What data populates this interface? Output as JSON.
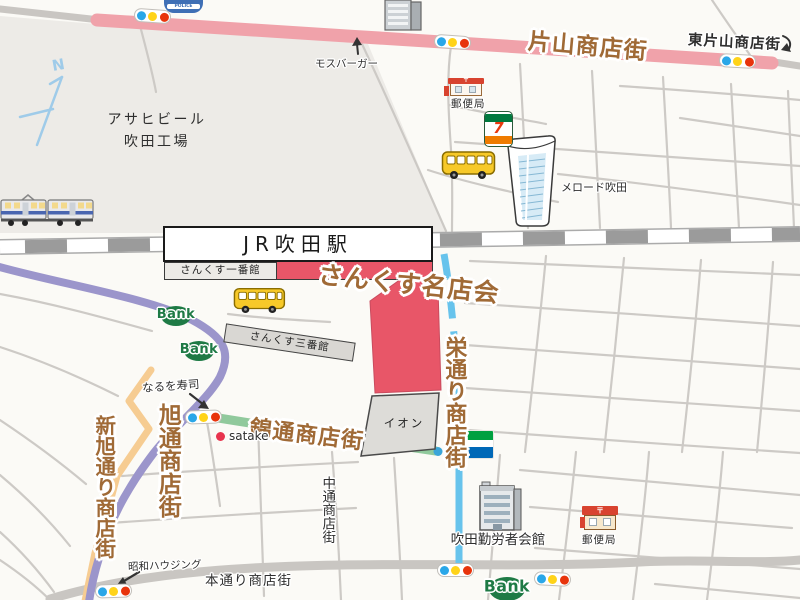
{
  "colors": {
    "bg": "#fbfaf6",
    "factory_tint": "#edebe7",
    "road_gray": "#c9c6c2",
    "road_thin": "#cbc8c4",
    "road_pink": "#f0a2aa",
    "road_purple": "#9b95cb",
    "road_blue": "#67c3ec",
    "road_green": "#90c99c",
    "road_orange": "#f6cc92",
    "rail_dark": "#9b9b9b",
    "block_red": "#e85668",
    "block_gray": "#dddcd8",
    "text_brown": "#a06a36",
    "text_dark": "#2e2e2e",
    "bank_green": "#1e7a45",
    "signal_blue": "#2aa7e8",
    "signal_yellow": "#ffd319",
    "signal_red": "#e8340c",
    "bus_yellow": "#f7c929",
    "police_blue": "#3f6fb5",
    "po_red": "#d8432f",
    "fm_green": "#00a040",
    "fm_blue": "#0068b7",
    "seven_green": "#00793f",
    "seven_orange": "#ef7b00",
    "seven_red": "#e8380d"
  },
  "compass": {
    "north": "N"
  },
  "icons_text": {
    "police": "POLICE",
    "postal_mark": "〒",
    "seven": "7",
    "familymart": "FamilyMart",
    "bank": "Bank"
  },
  "streets": {
    "katayama": "片山商店街",
    "higashi_katayama": "東片山商店街",
    "sakae_dori": "栄通り商店街",
    "nishiki_dori": "錦通商店街",
    "asahi_dori": "旭通商店街",
    "shin_asahi_dori": "新旭通り商店街",
    "naka_dori": "中通商店街",
    "hon_dori": "本通り商店街"
  },
  "places": {
    "asahi_beer_line1": "アサヒビール",
    "asahi_beer_line2": "吹田工場",
    "mos_burger": "モスバーガー",
    "post_office_top": "郵便局",
    "melodo_suita": "メロード吹田",
    "jr_suita_station": "JR吹田駅",
    "sanks_no1": "さんくす一番館",
    "sanks_meitenkai": "さんくす名店会",
    "sanks_no3": "さんくす三番館",
    "naruo_sushi": "なるを寿司",
    "satake": "satake",
    "aeon": "イオン",
    "showa_housing": "昭和ハウジング",
    "suita_workers_hall": "吹田勤労者会館",
    "post_office_bottom": "郵便局"
  }
}
